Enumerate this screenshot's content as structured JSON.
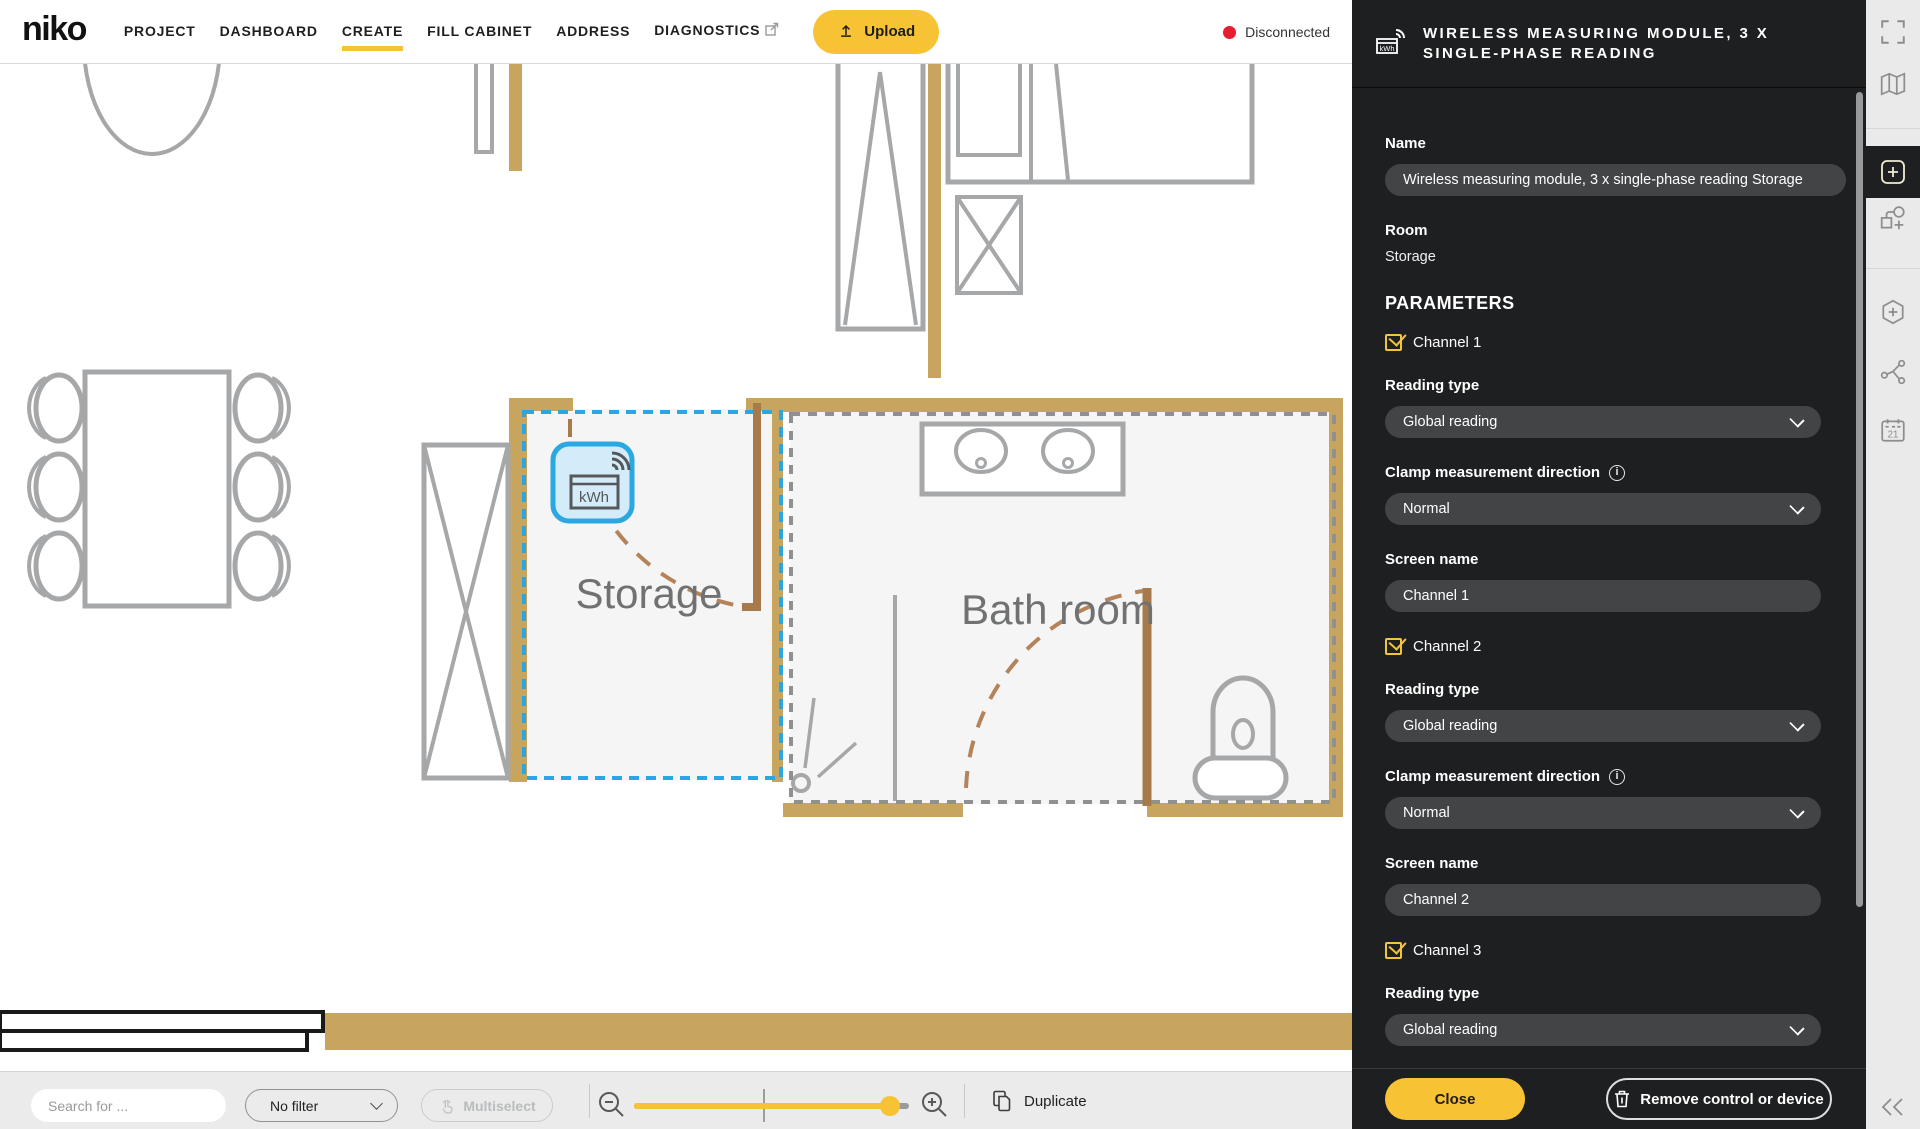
{
  "nav": {
    "logo": "niko",
    "items": [
      {
        "label": "PROJECT",
        "active": false
      },
      {
        "label": "DASHBOARD",
        "active": false
      },
      {
        "label": "CREATE",
        "active": true
      },
      {
        "label": "FILL CABINET",
        "active": false
      },
      {
        "label": "ADDRESS",
        "active": false
      },
      {
        "label": "DIAGNOSTICS",
        "active": false,
        "external": true
      }
    ],
    "upload_label": "Upload",
    "status_text": "Disconnected"
  },
  "canvas": {
    "rooms": [
      {
        "name": "Storage",
        "selected": true
      },
      {
        "name": "Bath room",
        "selected": false
      }
    ],
    "device_icon_label": "kWh"
  },
  "bottombar": {
    "search_placeholder": "Search for ...",
    "filter_value": "No filter",
    "multiselect_label": "Multiselect",
    "duplicate_label": "Duplicate"
  },
  "panel": {
    "title": "WIRELESS MEASURING MODULE, 3 X SINGLE-PHASE READING",
    "name_label": "Name",
    "name_value": "Wireless measuring module, 3 x single-phase reading Storage",
    "room_label": "Room",
    "room_value": "Storage",
    "parameters_label": "PARAMETERS",
    "channels": [
      {
        "label": "Channel 1",
        "checked": true,
        "reading_type_label": "Reading type",
        "reading_type": "Global reading",
        "clamp_label": "Clamp measurement direction",
        "clamp_value": "Normal",
        "screen_name_label": "Screen name",
        "screen_name": "Channel 1"
      },
      {
        "label": "Channel 2",
        "checked": true,
        "reading_type_label": "Reading type",
        "reading_type": "Global reading",
        "clamp_label": "Clamp measurement direction",
        "clamp_value": "Normal",
        "screen_name_label": "Screen name",
        "screen_name": "Channel 2"
      },
      {
        "label": "Channel 3",
        "checked": true,
        "reading_type_label": "Reading type",
        "reading_type": "Global reading",
        "clamp_label": "Clamp measurement direction"
      }
    ],
    "close_label": "Close",
    "remove_label": "Remove control or device"
  },
  "colors": {
    "accent_yellow": "#f7c233",
    "selection_blue": "#2aa7e2",
    "wall_tan": "#c8a55e",
    "door_brown": "#a67a4b",
    "status_red": "#e81c30",
    "panel_background": "#1e1f21"
  }
}
